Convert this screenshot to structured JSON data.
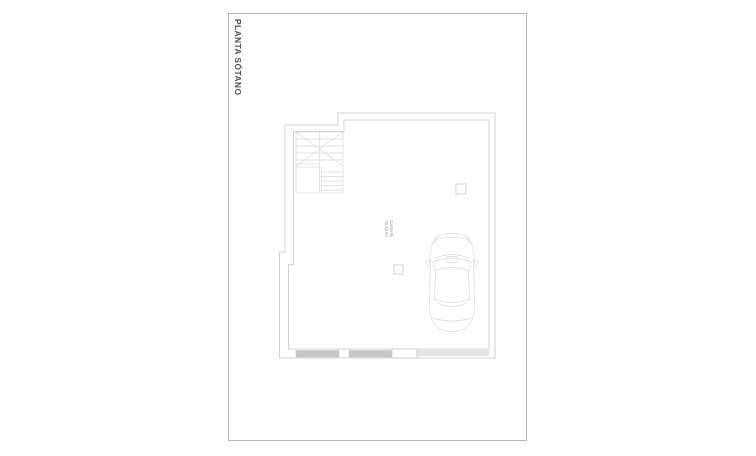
{
  "sheet": {
    "title": "PLANTA SÓTANO"
  },
  "plan": {
    "room_label_line1": "GARAJE",
    "room_label_line2": "75.10 m²"
  },
  "colors": {
    "frame": "#b5b9bc",
    "wall_line": "#c5c8ca",
    "detail_line": "#d7dadb",
    "wall_fill": "#c7c7c7",
    "wall_fill_light": "#e4e6e6",
    "title_text": "#4a4d4f",
    "label_text": "#8e9496"
  }
}
